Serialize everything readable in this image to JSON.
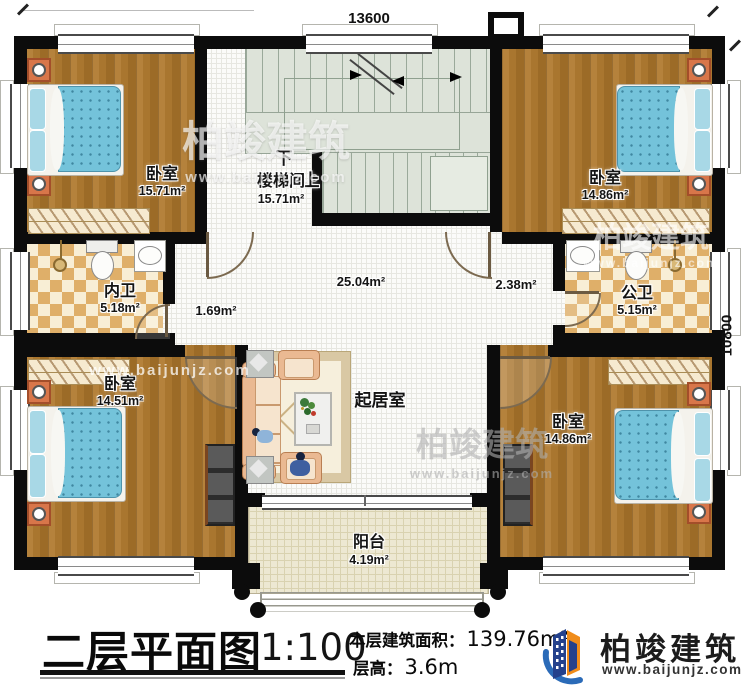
{
  "plan": {
    "dimension_top": "13600",
    "dimension_right": "10800",
    "rooms": {
      "bedroom_tl": {
        "name": "卧室",
        "area": "15.71m²"
      },
      "bedroom_tr": {
        "name": "卧室",
        "area": "14.86m²"
      },
      "bedroom_bl": {
        "name": "卧室",
        "area": "14.51m²"
      },
      "bedroom_br": {
        "name": "卧室",
        "area": "14.86m²"
      },
      "stairwell": {
        "name": "楼梯间",
        "area": "15.71m²",
        "down_label": "下",
        "up_label": "上"
      },
      "inner_bath": {
        "name": "内卫",
        "area": "5.18m²"
      },
      "public_bath": {
        "name": "公卫",
        "area": "5.15m²"
      },
      "living_room": {
        "name": "起居室",
        "hall_area": "25.04m²",
        "nook_left_area": "1.69m²",
        "nook_right_area": "2.38m²"
      },
      "balcony": {
        "name": "阳台",
        "area": "4.19m²"
      }
    }
  },
  "title_block": {
    "title": "二层平面图",
    "scale": "1:100",
    "floor_area_label": "本层建筑面积：",
    "floor_area_value": "139.76m²",
    "floor_height_label": "层高：",
    "floor_height_value": "3.6m"
  },
  "logo": {
    "brand": "柏竣建筑",
    "url": "www.baijunjz.com"
  },
  "watermark": {
    "brand": "柏竣建筑",
    "url": "www.baijunjz.com"
  },
  "colors": {
    "wall": "#0c0c0c",
    "wood": "#a9762f",
    "tile": "#fbfbf9",
    "checker": "#dfaf69",
    "stairs": "#dde3d9",
    "balcony": "#ede8d2",
    "bed": "#74c3da",
    "furniture_orange": "#d8764a",
    "logo_blue": "#24418c",
    "logo_orange": "#f08c1a"
  }
}
